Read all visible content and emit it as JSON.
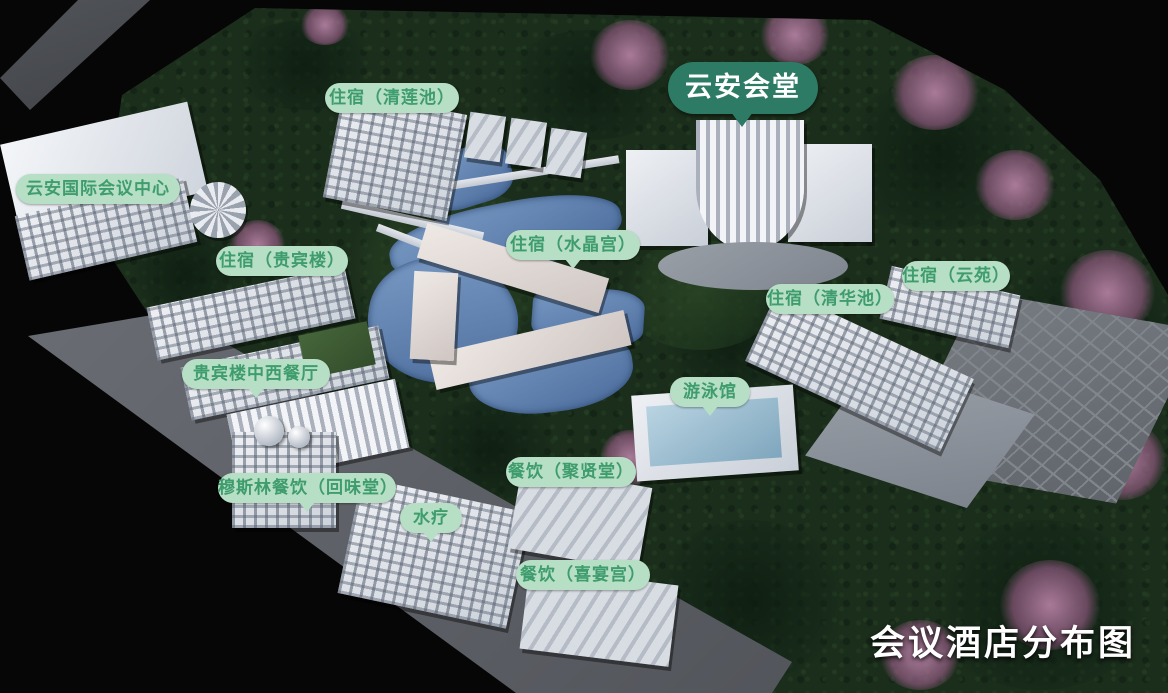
{
  "title": {
    "text": "会议酒店分布图"
  },
  "map": {
    "main_badge": {
      "text": "云安会堂"
    },
    "labels": {
      "qinglianchi": {
        "text": "住宿（清莲池）"
      },
      "conference_center": {
        "text": "云安国际会议中心"
      },
      "guibinlou": {
        "text": "住宿（贵宾楼）"
      },
      "shuijinggong": {
        "text": "住宿（水晶宫）"
      },
      "qinghuachi": {
        "text": "住宿（清华池）"
      },
      "yunyuan": {
        "text": "住宿（云苑）"
      },
      "guibinlou_restaurant": {
        "text": "贵宾楼中西餐厅"
      },
      "youyongguan": {
        "text": "游泳馆"
      },
      "muslim_restaurant": {
        "text": "穆斯林餐饮（回味堂）"
      },
      "shuiliao": {
        "text": "水疗"
      },
      "juxiantang": {
        "text": "餐饮（聚贤堂）"
      },
      "xiyangong": {
        "text": "餐饮（喜宴宫）"
      }
    },
    "colors": {
      "background": "#060606",
      "foliage": "#1b2d1b",
      "road": "#5b5e64",
      "water": "#5d80ad",
      "building": "#c9cfd8",
      "blossom": "#b37ba0",
      "label_bg": "#b7dfc5",
      "label_text": "#3e9c6d",
      "badge_dark_bg": "#2e7b65",
      "badge_dark_text": "#ffffff",
      "title_text": "#ffffff"
    }
  }
}
